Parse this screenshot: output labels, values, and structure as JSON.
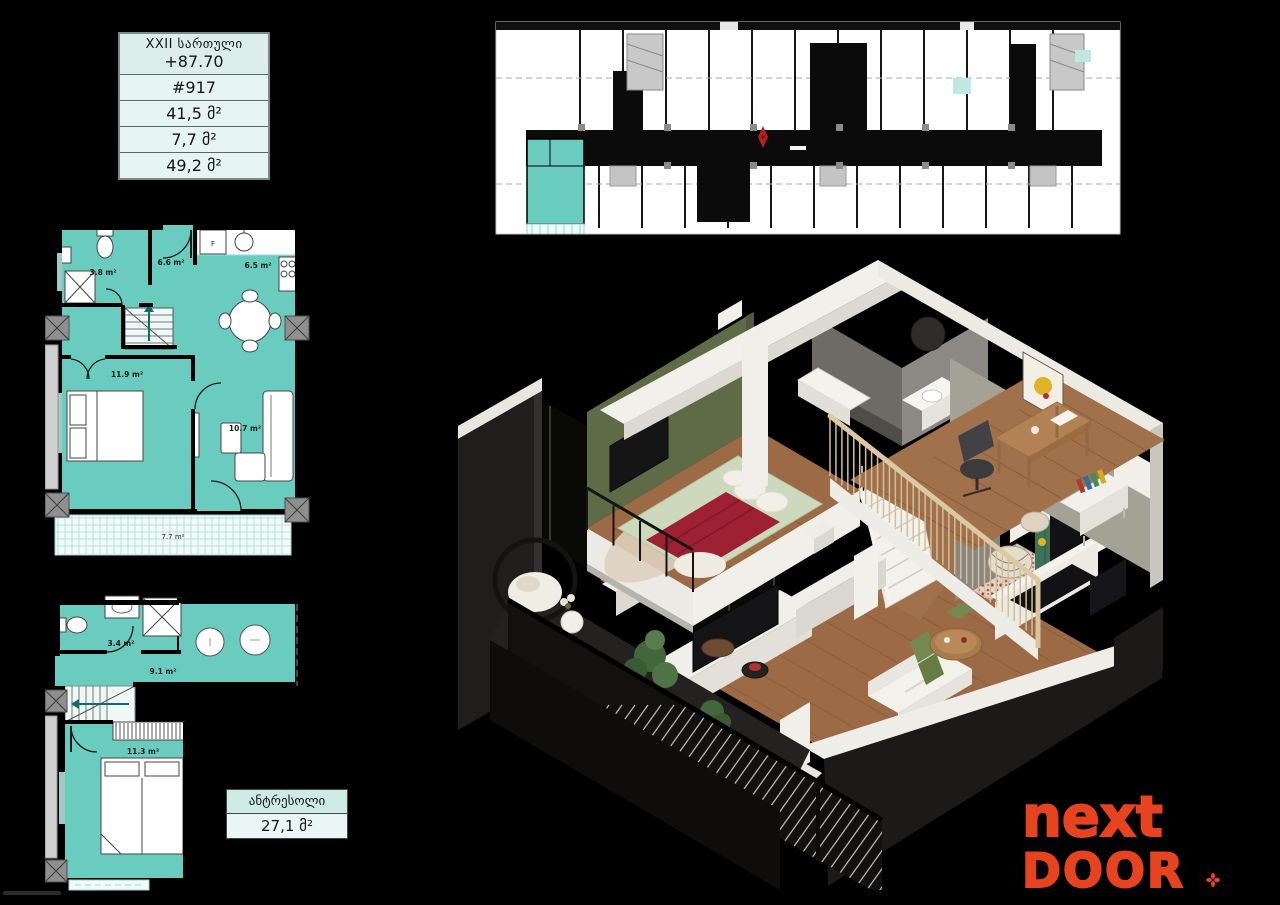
{
  "info_table": {
    "floor_label": "XXII სართული",
    "elevation": "+87.70",
    "unit_number": "#917",
    "area_apartment": "41,5 მ²",
    "area_balcony": "7,7 მ²",
    "area_total": "49,2 მ²"
  },
  "mezzanine_box": {
    "title": "ანტრესოლი",
    "area": "27,1 მ²"
  },
  "lower_plan_labels": {
    "bathroom": "3.8 m²",
    "hall": "6.6 m²",
    "kitchen": "6.5 m²",
    "bedroom": "11.9 m²",
    "living": "10.7 m²",
    "balcony": "7.7 m²",
    "fridge": "F"
  },
  "upper_plan_labels": {
    "bathroom": "3.4 m²",
    "hall": "9.1 m²",
    "bedroom": "11.3 m²"
  },
  "logo": {
    "word_top": "next",
    "word_bottom": "DOOR",
    "mark_icon": "flower-asterisk"
  },
  "colors": {
    "teal_fill": "#6accbf",
    "mint_panel": "#e7f5f2",
    "logo_orange": "#e8431f",
    "plan_wall": "#000000",
    "north_marker_red": "#b02020"
  }
}
